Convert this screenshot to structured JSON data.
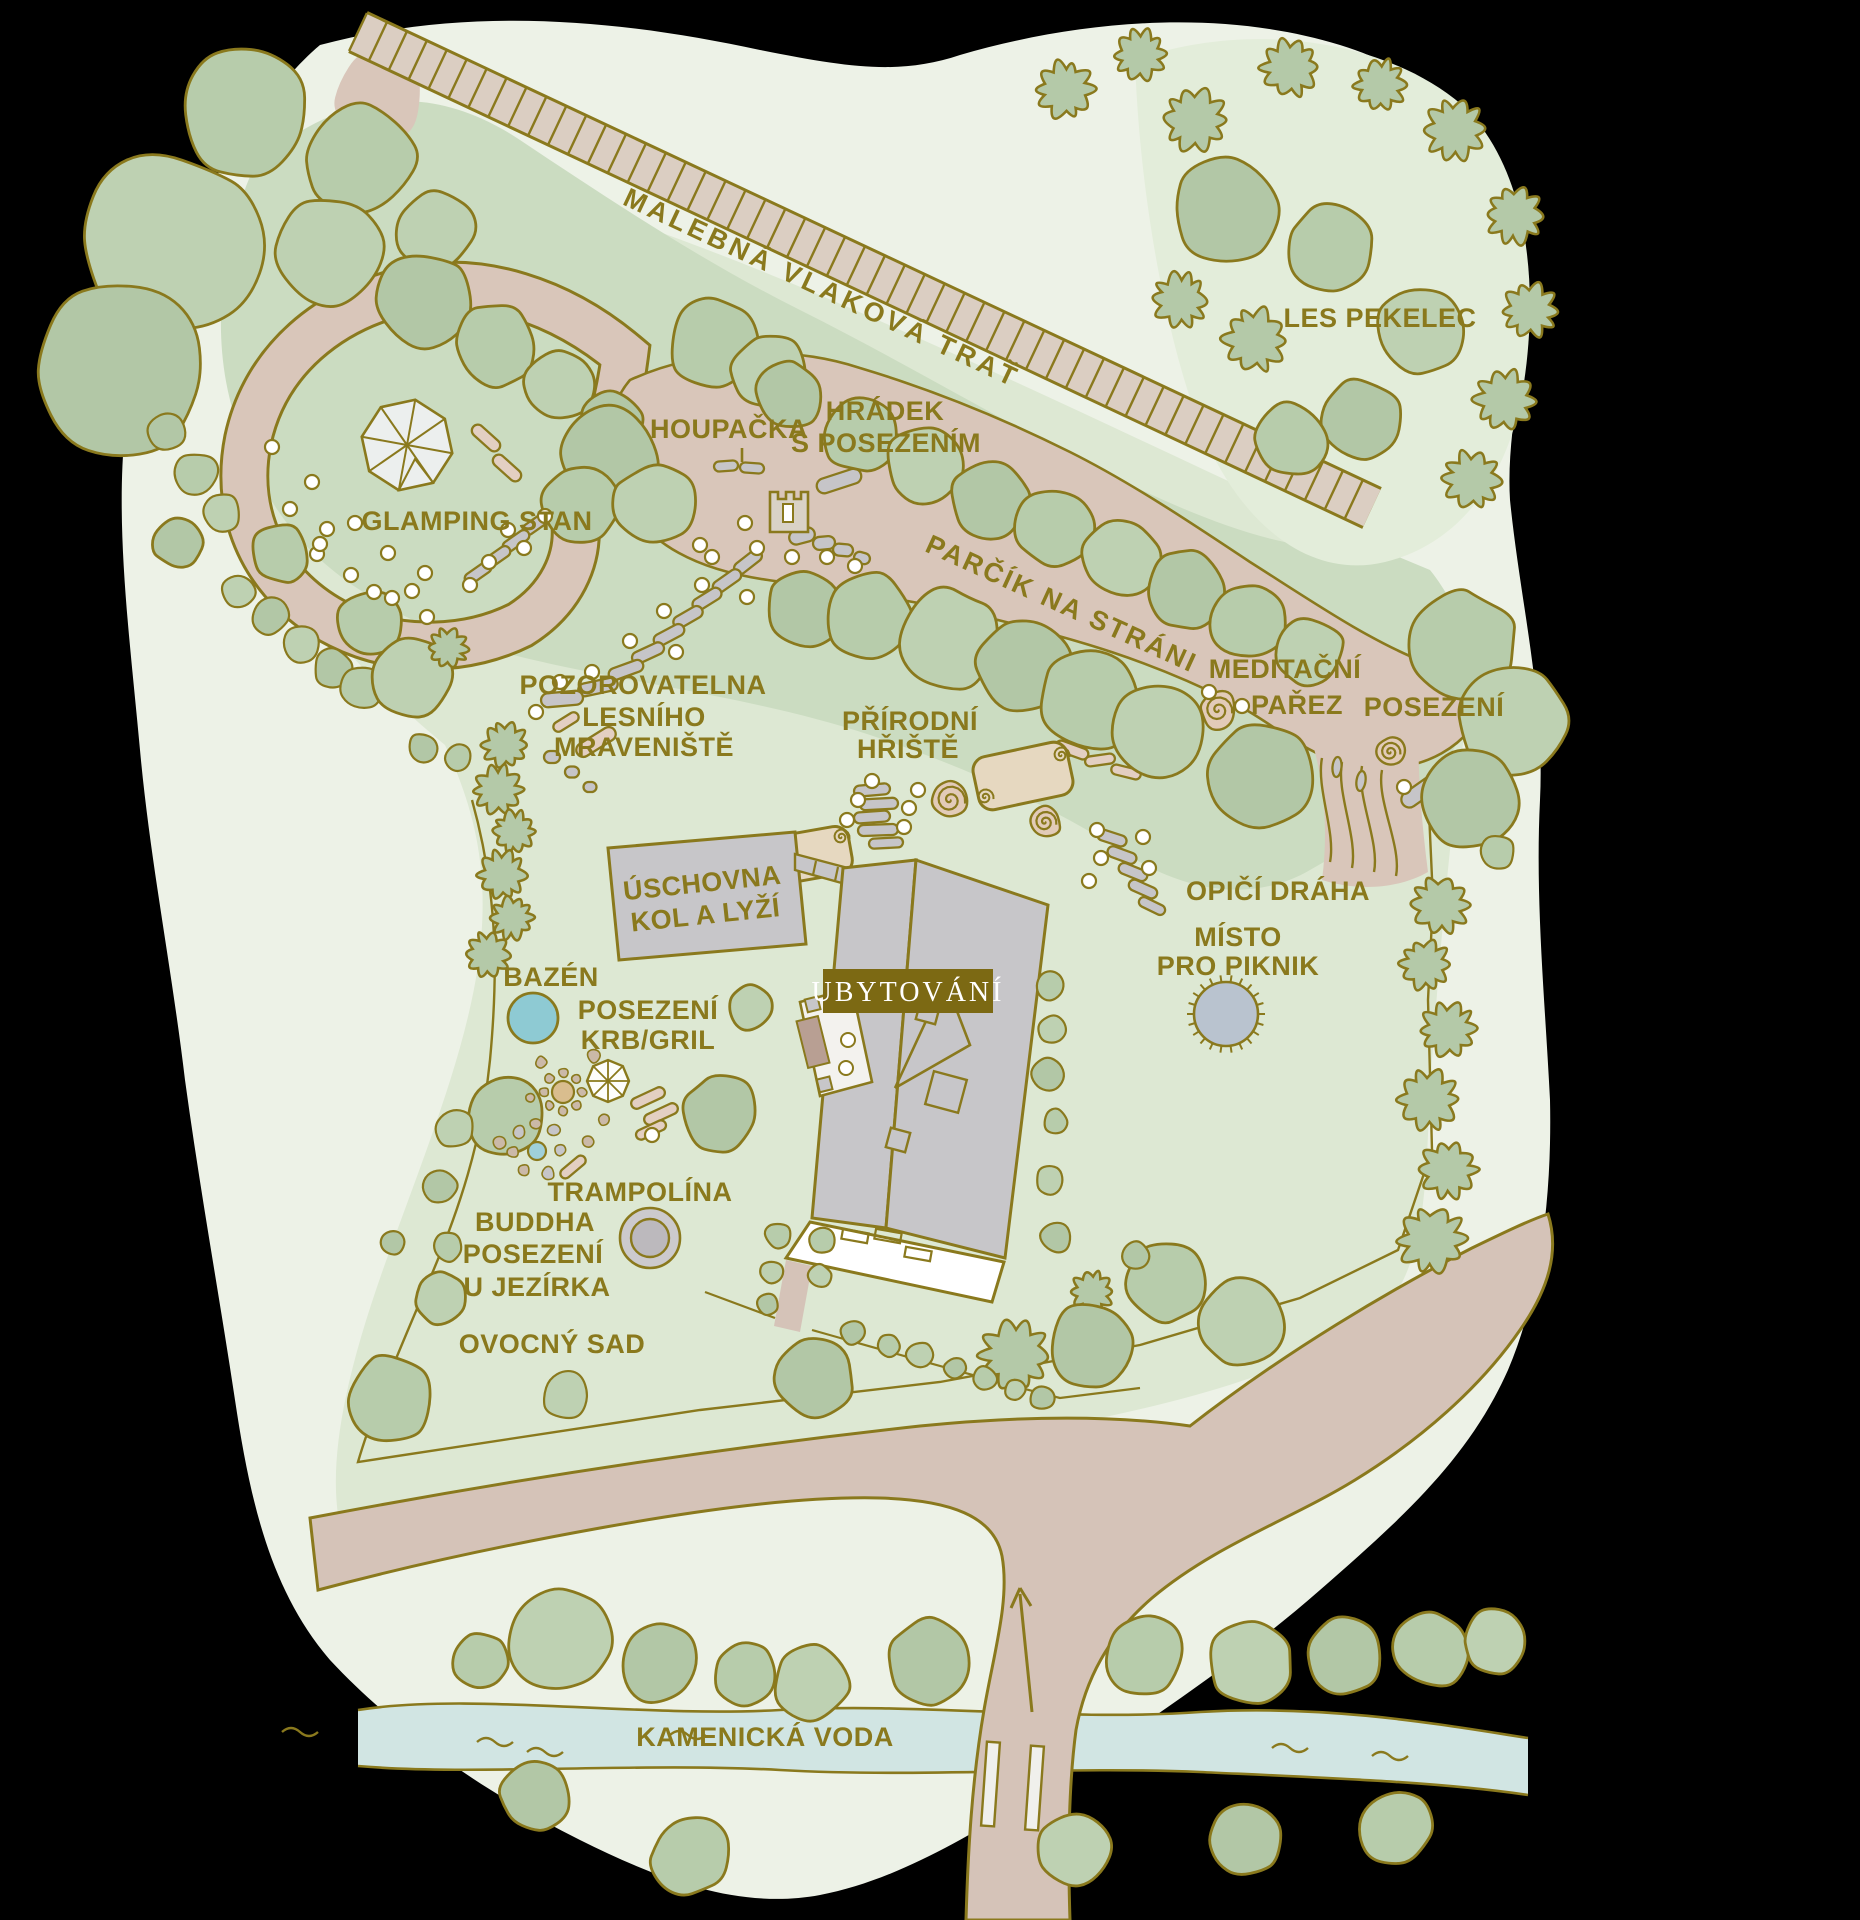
{
  "map": {
    "labels": {
      "railway": "MALEBNÁ VLAKOVÁ TRAŤ",
      "forest": "LES PEKELEC",
      "glamping": "GLAMPING STAN",
      "swing": "HOUPAČKA",
      "castle_line1": "HRÁDEK",
      "castle_line2": "S POSEZENÍM",
      "hill_park": "PARČÍK NA STRÁNI",
      "meditation_line1": "MEDITAČNÍ",
      "meditation_line2": "PAŘEZ",
      "seating_east": "POSEZENÍ",
      "anthill_line1": "POZOROVATELNA",
      "anthill_line2": "LESNÍHO",
      "anthill_line3": "MRAVENIŠTĚ",
      "playground_line1": "PŘÍRODNÍ",
      "playground_line2": "HŘIŠTĚ",
      "storage_line1": "ÚSCHOVNA",
      "storage_line2": "KOL A LYŽÍ",
      "accommodation": "UBYTOVÁNÍ",
      "monkey_course": "OPIČÍ DRÁHA",
      "picnic_line1": "MÍSTO",
      "picnic_line2": "PRO PIKNIK",
      "pool": "BAZÉN",
      "fireplace_line1": "POSEZENÍ",
      "fireplace_line2": "KRB/GRIL",
      "trampoline": "TRAMPOLÍNA",
      "buddha_line1": "BUDDHA",
      "buddha_line2": "POSEZENÍ",
      "buddha_line3": "U JEZÍRKA",
      "orchard": "OVOCNÝ SAD",
      "stream": "KAMENICKÁ VODA"
    },
    "colors": {
      "label_text": "#8a791d",
      "outline": "#8a791d",
      "accommodation_badge_bg": "#7c6913",
      "accommodation_badge_text": "#ffffff",
      "tree_fill": "#b7ccab",
      "path_fill": "#d9c6ba",
      "building_fill": "#c7c6c9",
      "pool_fill": "#8ecad3",
      "stream_fill": "#d1e5e3",
      "picnic_fill": "#b9c3cf"
    }
  }
}
